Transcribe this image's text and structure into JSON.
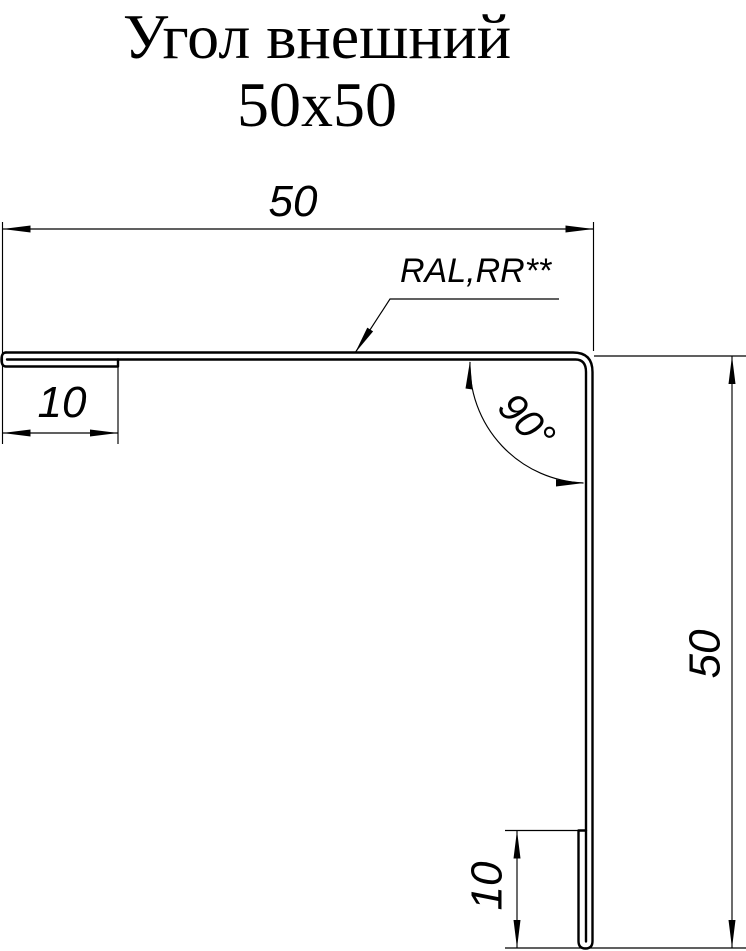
{
  "title": {
    "line1": "Угол внешний",
    "line2": "50x50"
  },
  "dimensions": {
    "top_width": "50",
    "left_fold": "10",
    "right_height": "50",
    "bottom_fold": "10",
    "corner_angle": "90°",
    "coating_note": "RAL,RR**"
  },
  "colors": {
    "line": "#000000",
    "background": "#ffffff"
  }
}
